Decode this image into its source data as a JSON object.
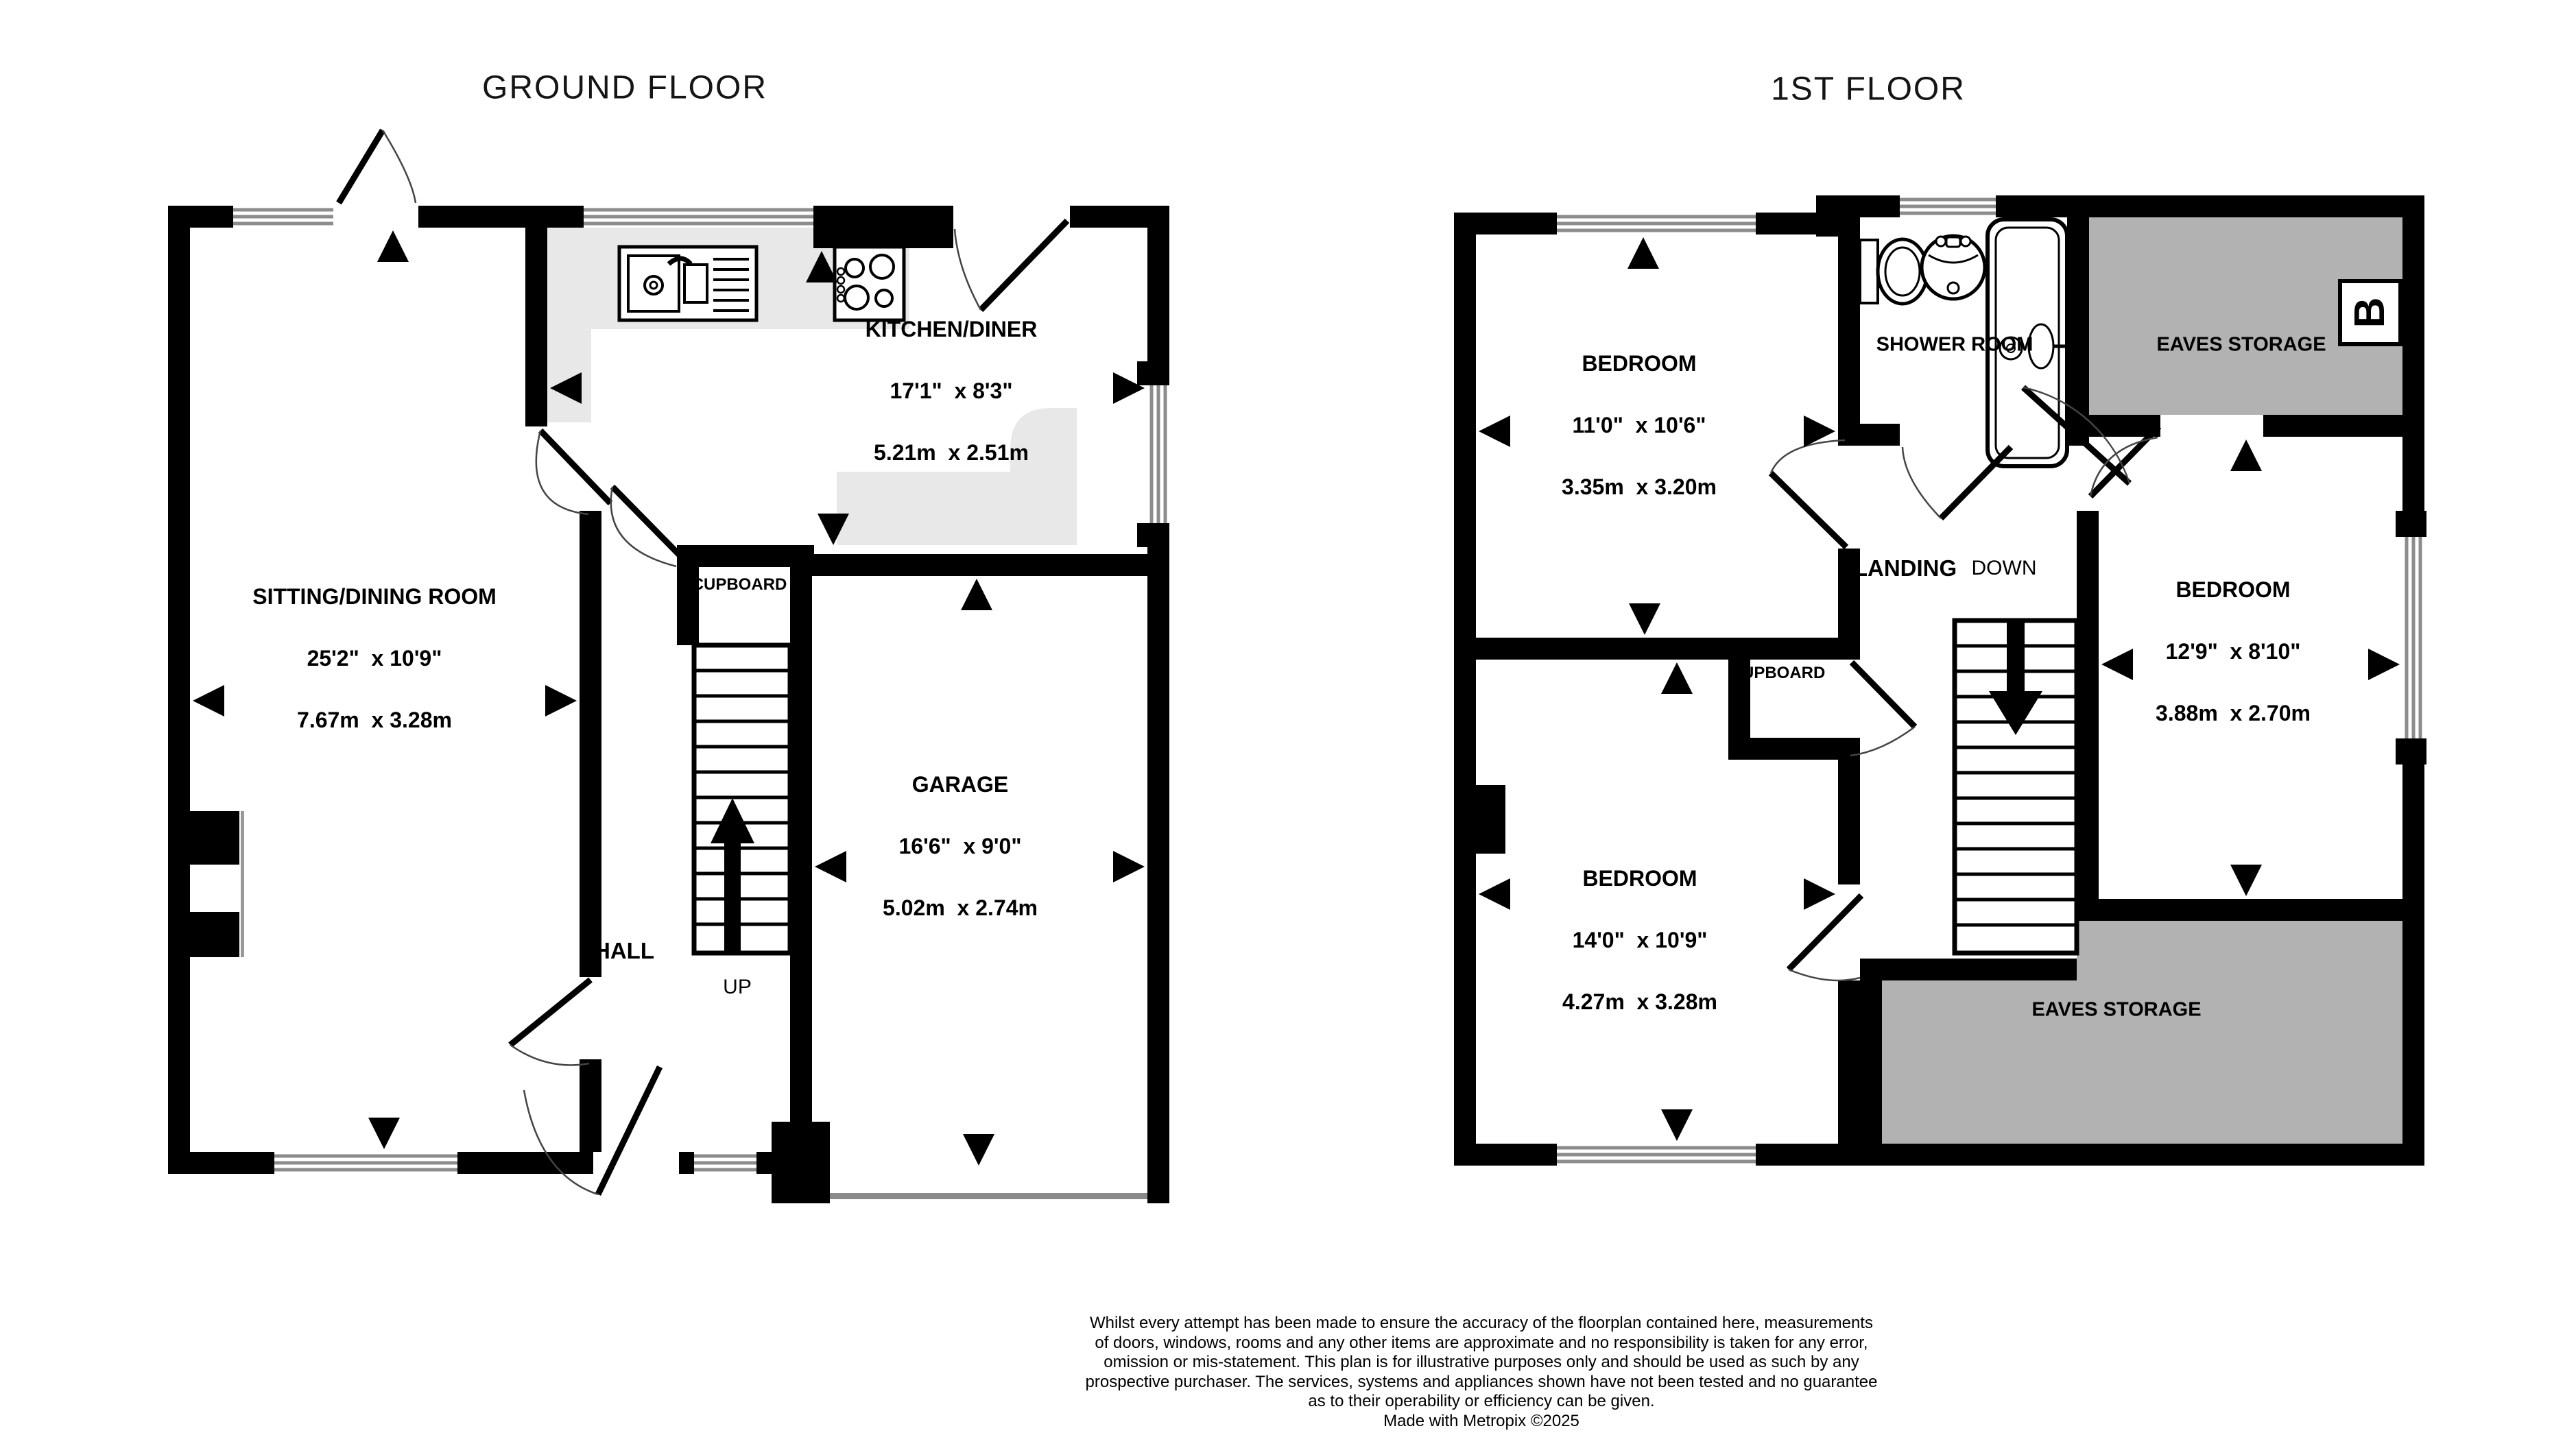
{
  "ground_floor": {
    "title": "GROUND FLOOR",
    "kitchen": {
      "name": "KITCHEN/DINER",
      "imperial": "17'1\"  x 8'3\"",
      "metric": "5.21m  x 2.51m"
    },
    "sitting": {
      "name": "SITTING/DINING ROOM",
      "imperial": "25'2\"  x 10'9\"",
      "metric": "7.67m  x 3.28m"
    },
    "garage": {
      "name": "GARAGE",
      "imperial": "16'6\"  x 9'0\"",
      "metric": "5.02m  x 2.74m"
    },
    "hall_label": "HALL",
    "cupboard_label": "CUPBOARD",
    "stairs_label": "UP"
  },
  "first_floor": {
    "title": "1ST FLOOR",
    "bedroom_front": {
      "name": "BEDROOM",
      "imperial": "11'0\"  x 10'6\"",
      "metric": "3.35m  x 3.20m"
    },
    "bedroom_side": {
      "name": "BEDROOM",
      "imperial": "12'9\"  x 8'10\"",
      "metric": "3.88m  x 2.70m"
    },
    "bedroom_back": {
      "name": "BEDROOM",
      "imperial": "14'0\"  x 10'9\"",
      "metric": "4.27m  x 3.28m"
    },
    "shower_label": "SHOWER ROOM",
    "landing_label": "LANDING",
    "stairs_label": "DOWN",
    "cupboard_label": "CUPBOARD",
    "eaves_top_label": "EAVES STORAGE",
    "eaves_bottom_label": "EAVES STORAGE",
    "logo_letter": "B"
  },
  "footer": {
    "line1": "Whilst every attempt has been made to ensure the accuracy of the floorplan contained here, measurements",
    "line2": "of doors, windows, rooms and any other items are approximate and no responsibility is taken for any error,",
    "line3": "omission or mis-statement. This plan is for illustrative purposes only and should be used as such by any",
    "line4": "prospective purchaser. The services, systems and appliances shown have not been tested and no guarantee",
    "line5": "as to their operability or efficiency can be given.",
    "line6": "Made with Metropix ©2025"
  },
  "colors": {
    "wall": "#000000",
    "counter": "#e8e8e8",
    "eaves": "#b2b2b2",
    "window_line": "#8c8c8c",
    "garage_door_line": "#8a8a8a"
  }
}
